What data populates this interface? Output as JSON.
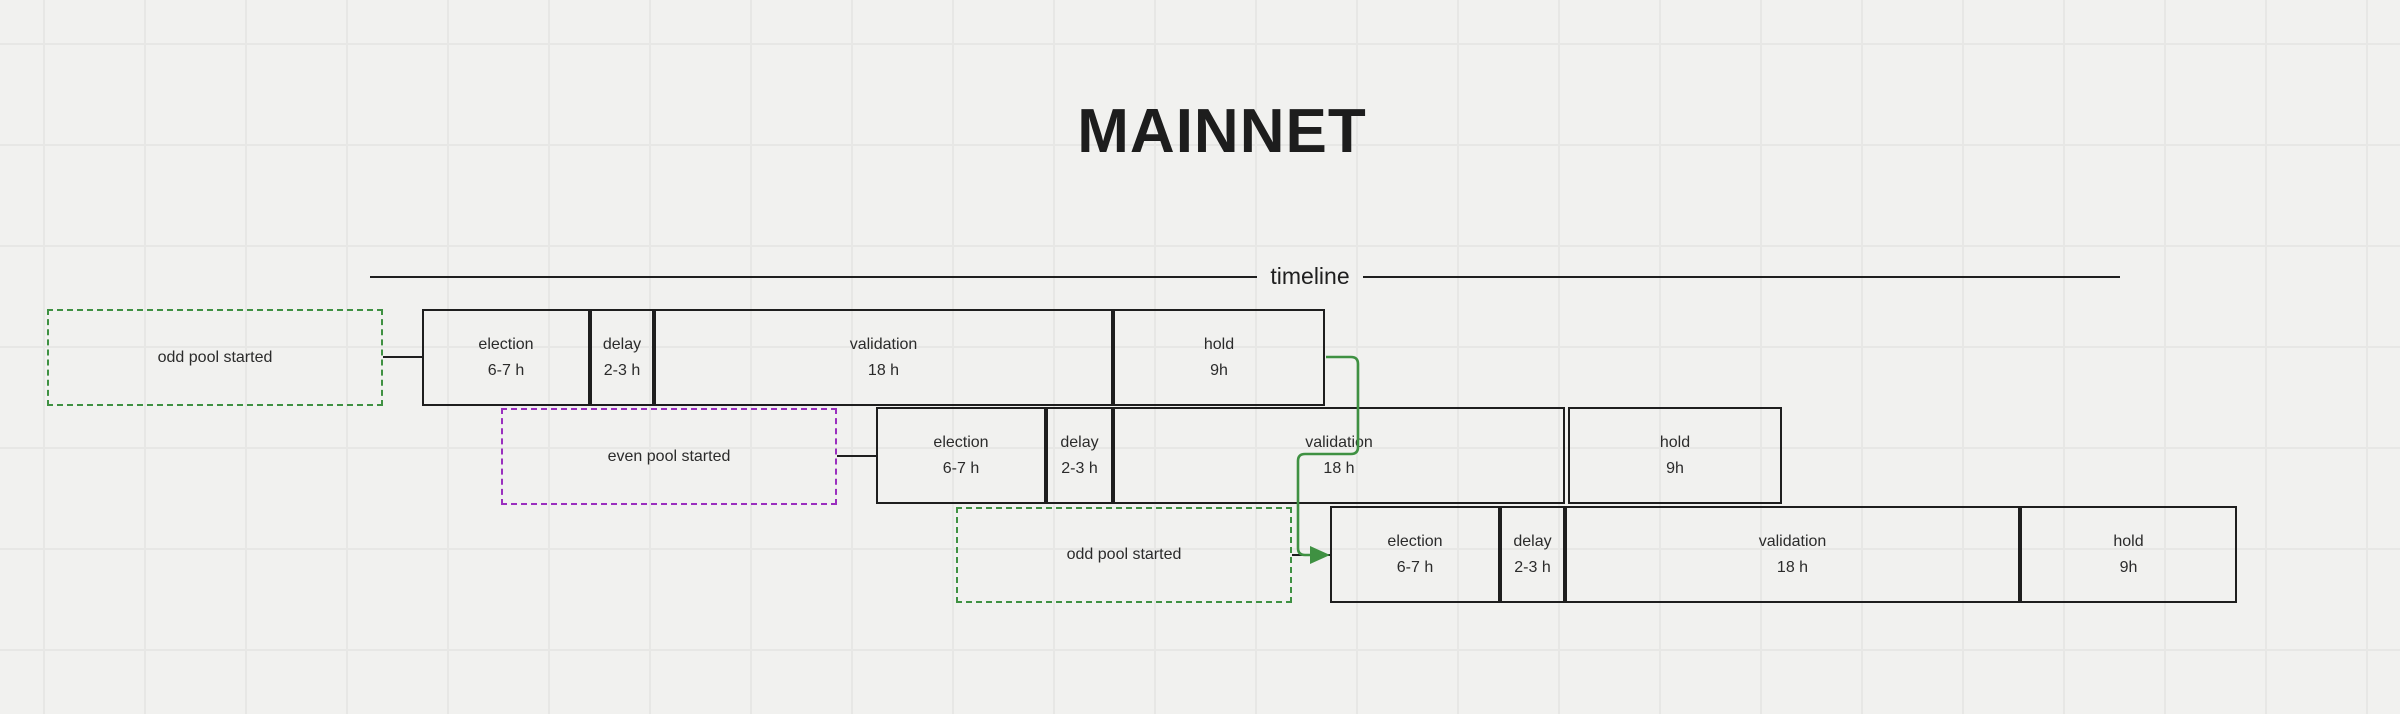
{
  "diagram": {
    "title": "MAINNET",
    "timeline_label": "timeline"
  },
  "colors": {
    "odd_pool_green": "#3f9142",
    "even_pool_purple": "#9a2fbe",
    "stroke_dark": "#1f1f1f",
    "background": "#f1f1ef",
    "grid_line": "#e7e7e5"
  },
  "rows": [
    {
      "trigger": "odd pool started",
      "pool": "odd",
      "phases": [
        {
          "name": "election",
          "duration": "6-7 h"
        },
        {
          "name": "delay",
          "duration": "2-3 h"
        },
        {
          "name": "validation",
          "duration": "18 h"
        },
        {
          "name": "hold",
          "duration": "9h"
        }
      ]
    },
    {
      "trigger": "even pool started",
      "pool": "even",
      "phases": [
        {
          "name": "election",
          "duration": "6-7 h"
        },
        {
          "name": "delay",
          "duration": "2-3 h"
        },
        {
          "name": "validation",
          "duration": "18 h"
        },
        {
          "name": "hold",
          "duration": "9h"
        }
      ]
    },
    {
      "trigger": "odd pool started",
      "pool": "odd",
      "phases": [
        {
          "name": "election",
          "duration": "6-7 h"
        },
        {
          "name": "delay",
          "duration": "2-3 h"
        },
        {
          "name": "validation",
          "duration": "18 h"
        },
        {
          "name": "hold",
          "duration": "9h"
        }
      ]
    }
  ]
}
